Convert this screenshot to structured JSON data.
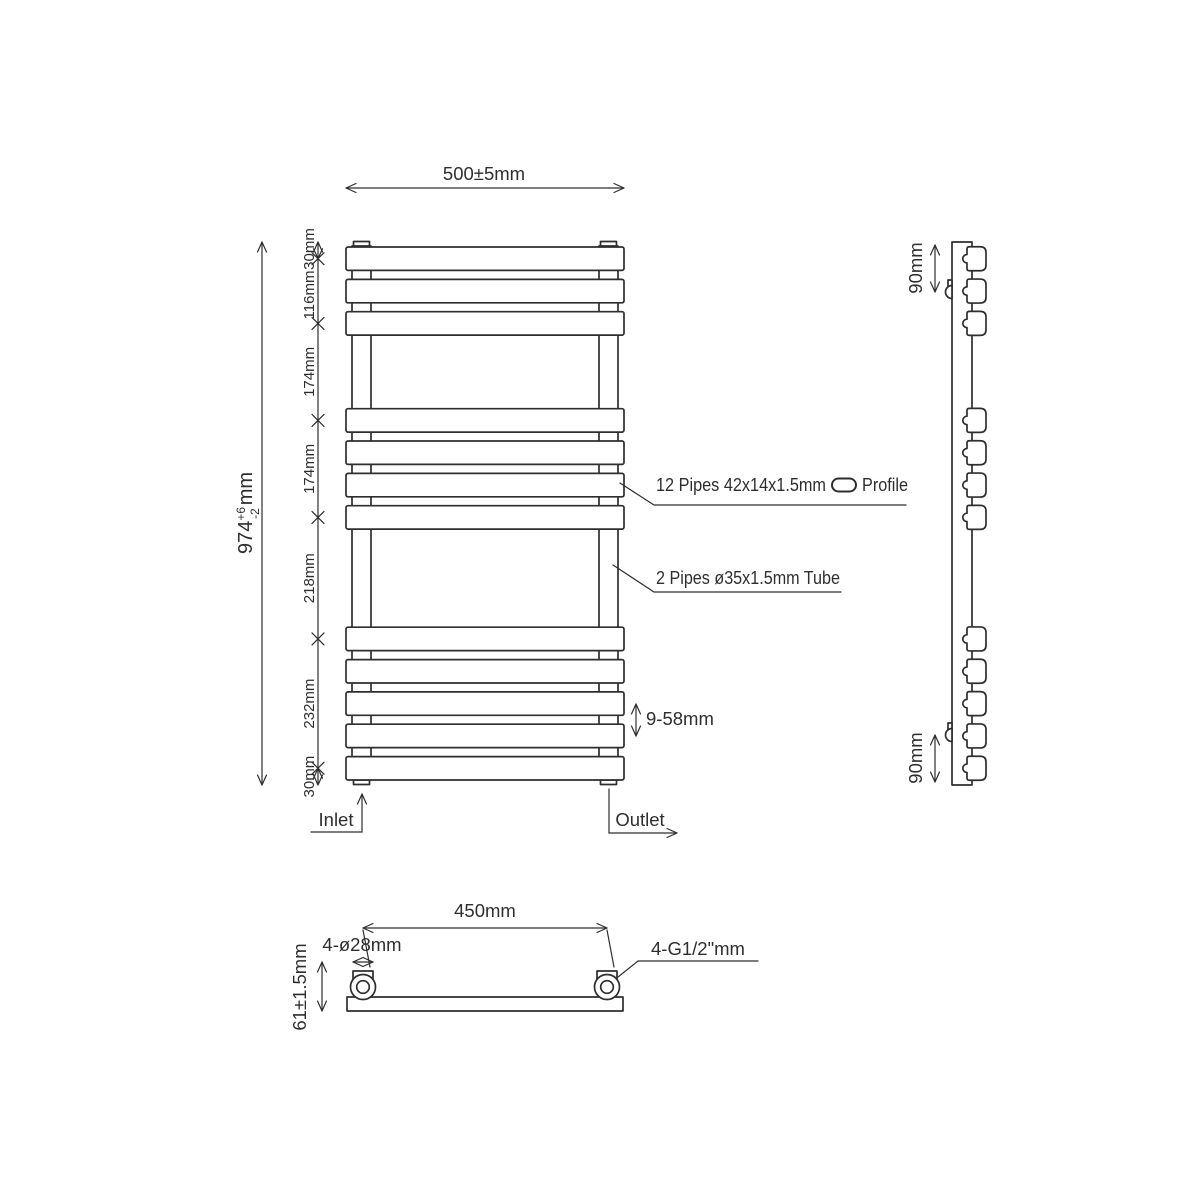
{
  "colors": {
    "line": "#2e2e2e",
    "background": "#ffffff"
  },
  "front_view": {
    "width_dim": "500±5mm",
    "overall_height": {
      "value": "974",
      "tol_plus": "+6",
      "tol_minus": "-2",
      "unit": "mm"
    },
    "height_chain": [
      "30mm",
      "116mm",
      "174mm",
      "174mm",
      "218mm",
      "232mm",
      "30mm"
    ],
    "pipe_label": {
      "text": "12 Pipes 42x14x1.5mm",
      "icon": "flat-pipe-profile-pill",
      "suffix": "Profile"
    },
    "tube_label": "2 Pipes ø35x1.5mm Tube",
    "pitch_label": "9-58mm",
    "inlet_label": "Inlet",
    "outlet_label": "Outlet",
    "pipe_count": 12,
    "pipe_groups": [
      3,
      4,
      5
    ],
    "pipe_centers_mm": [
      30,
      88,
      146,
      320,
      378,
      436,
      494,
      712,
      770,
      828,
      886,
      944
    ]
  },
  "side_view": {
    "bracket_top_dim": "90mm",
    "bracket_bottom_dim": "90mm"
  },
  "bottom_view": {
    "centers_dim": "450mm",
    "hole_dim": "4-ø28mm",
    "depth_dim": "61±1.5mm",
    "thread_dim": "4-G1/2\"mm"
  }
}
